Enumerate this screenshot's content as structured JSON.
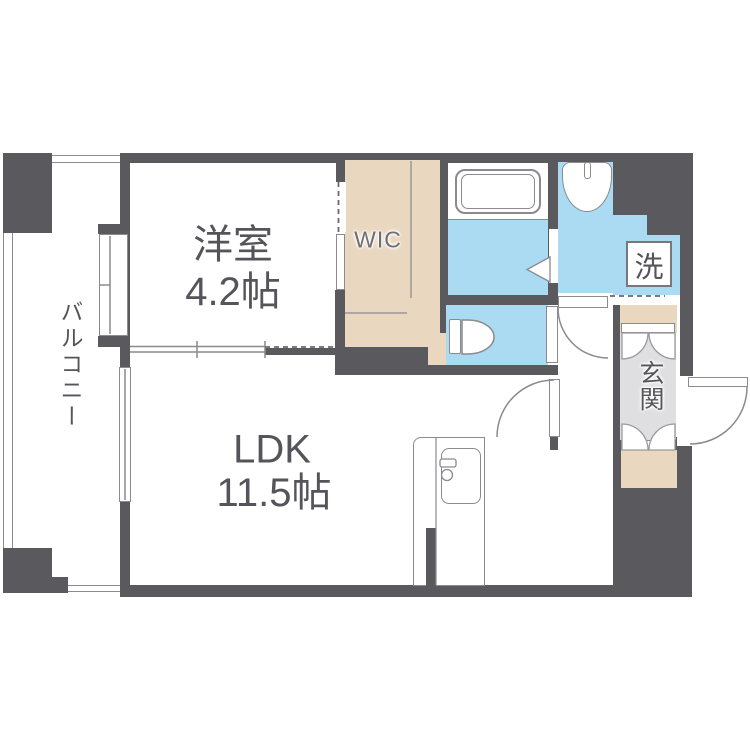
{
  "plan": {
    "type": "apartment-floor-plan",
    "rooms": {
      "western_room": {
        "name": "洋室",
        "size": "4.2帖"
      },
      "ldk": {
        "name": "LDK",
        "size": "11.5帖"
      },
      "wic": {
        "name": "WIC"
      },
      "balcony": {
        "name": "バルコニー"
      },
      "entrance": {
        "name": "玄関"
      },
      "laundry_symbol": "洗"
    },
    "colors": {
      "wall": "#5a5a5e",
      "closet_beige": "#e9d7bf",
      "wet_area_blue": "#abdaf3",
      "entrance_gray": "#dfdfe1",
      "fixture_line": "#8a8a8f",
      "label_text": "#54545a"
    }
  }
}
